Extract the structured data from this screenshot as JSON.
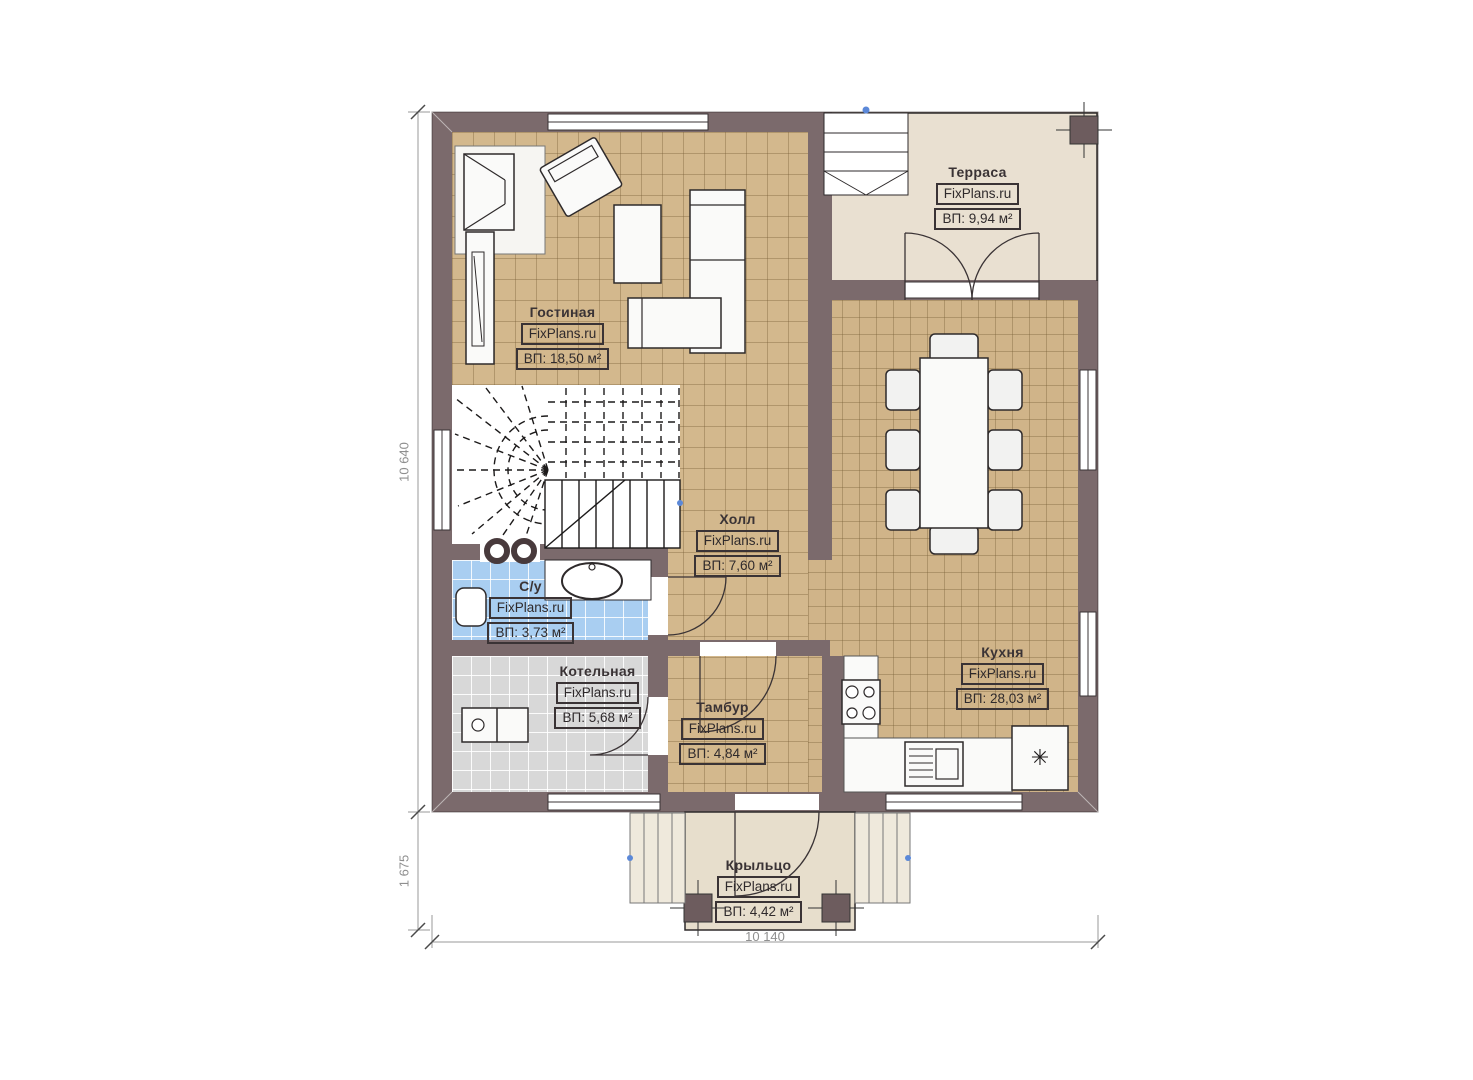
{
  "plan": {
    "site_watermark": "FixPlans.ru",
    "rooms": [
      {
        "id": "terrace",
        "name": "Терраса",
        "site": "FixPlans.ru",
        "area": "ВП: 9,94 м²"
      },
      {
        "id": "living",
        "name": "Гостиная",
        "site": "FixPlans.ru",
        "area": "ВП: 18,50 м²"
      },
      {
        "id": "hall",
        "name": "Холл",
        "site": "FixPlans.ru",
        "area": "ВП: 7,60 м²"
      },
      {
        "id": "bathroom",
        "name": "С/у",
        "site": "FixPlans.ru",
        "area": "ВП: 3,73 м²"
      },
      {
        "id": "boiler",
        "name": "Котельная",
        "site": "FixPlans.ru",
        "area": "ВП: 5,68 м²"
      },
      {
        "id": "vestibule",
        "name": "Тамбур",
        "site": "FixPlans.ru",
        "area": "ВП: 4,84 м²"
      },
      {
        "id": "kitchen",
        "name": "Кухня",
        "site": "FixPlans.ru",
        "area": "ВП: 28,03 м²"
      },
      {
        "id": "porch",
        "name": "Крыльцо",
        "site": "FixPlans.ru",
        "area": "ВП: 4,42 м²"
      }
    ],
    "dimensions": {
      "left_total": "10 640",
      "left_porch": "1 675",
      "bottom_total": "10 140"
    },
    "icons": {
      "fridge_snowflake": "✳"
    },
    "colors": {
      "wall": "#7b6a6c",
      "floor_tile_tan": "#d3b88d",
      "floor_terrace": "#e9e0d1",
      "floor_porch": "#e7decc",
      "floor_bathroom": "#a9cef1",
      "floor_boiler": "#d8d8d8",
      "marker_blue": "#5b88d8"
    }
  }
}
